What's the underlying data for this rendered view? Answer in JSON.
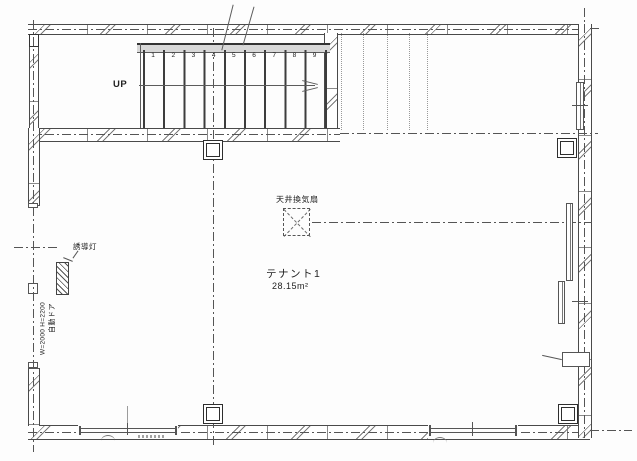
{
  "stairs": {
    "up_label": "UP",
    "step_numbers": [
      "1",
      "2",
      "3",
      "4",
      "5",
      "6",
      "7",
      "8",
      "9"
    ]
  },
  "labels": {
    "ceiling_fan": "天井換気扇",
    "tenant_name": "テナント1",
    "tenant_area": "28.15m²",
    "guide_light": "誘導灯",
    "auto_door": "自動ドア",
    "auto_door_size": "W=2000 H=2200"
  },
  "colors": {
    "line": "#4a4a4a",
    "dark_line": "#2e2e2e",
    "paper": "#fdfdfd"
  }
}
